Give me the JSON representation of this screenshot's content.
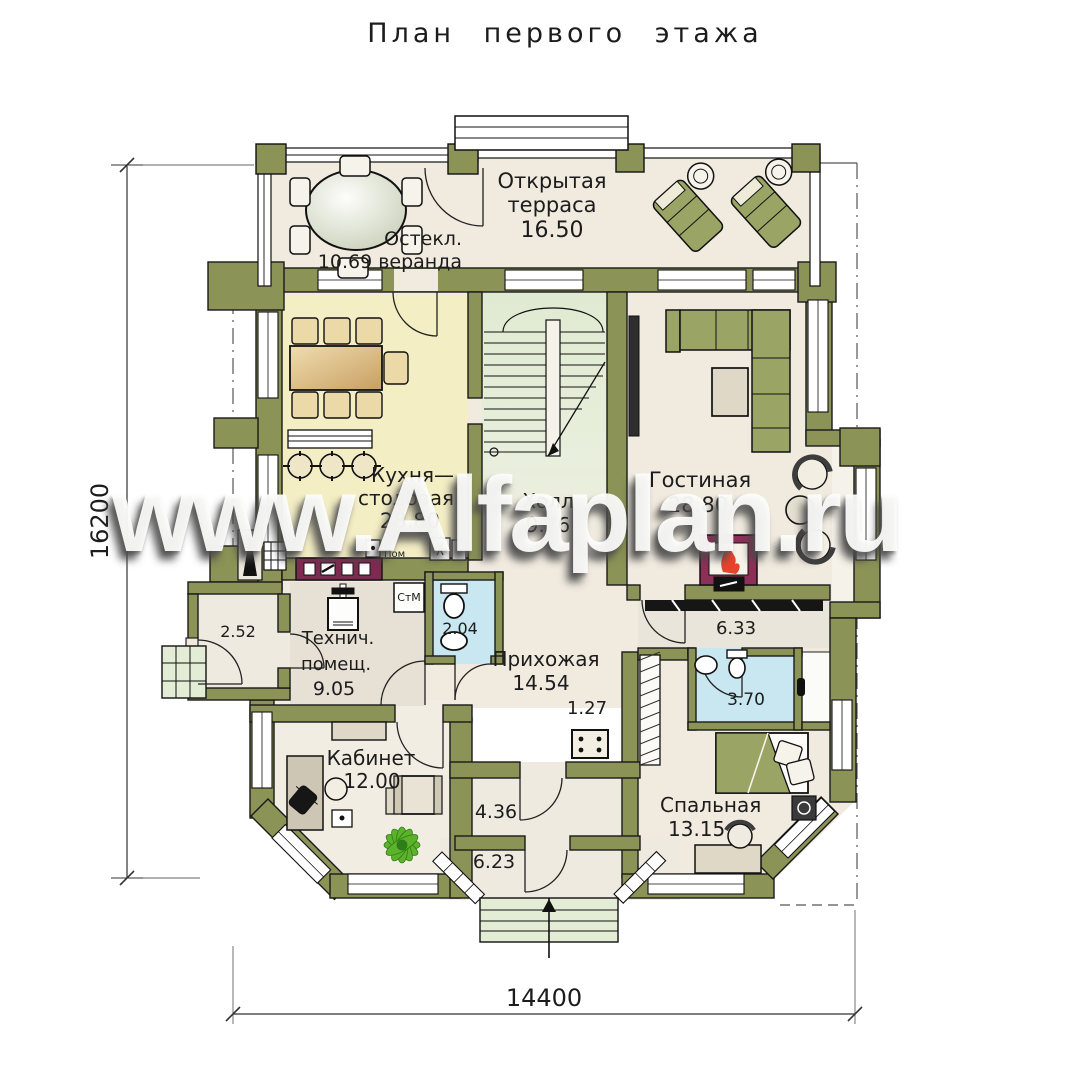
{
  "title": "План первого этажа",
  "watermark": "www.Alfaplan.ru",
  "dims": {
    "left": "16200",
    "bottom": "14400"
  },
  "rooms": {
    "terrace": {
      "l1": "Открытая",
      "l2": "терраса",
      "area": "16.50"
    },
    "veranda": {
      "l1": "Остекл.",
      "l2": "10.69 веранда"
    },
    "kitchen": {
      "l1": "Кухня—",
      "l2": "столовая",
      "area": "28.80"
    },
    "living": {
      "name": "Гостиная",
      "area": "28.80"
    },
    "hall": {
      "name": "Холл",
      "area": "9.76"
    },
    "tech": {
      "l1": "Технич.",
      "l2": "помещ.",
      "area": "9.05"
    },
    "entry": {
      "name": "Прихожая",
      "area": "14.54"
    },
    "closet": {
      "area": "1.27"
    },
    "office": {
      "name": "Кабинет",
      "area": "12.00"
    },
    "bedroom": {
      "name": "Спальная",
      "area": "13.15"
    },
    "bath1": {
      "area": "2.04"
    },
    "bath2": {
      "area": "3.70"
    },
    "vestibule": {
      "area": "2.52"
    },
    "corridor": {
      "area": "6.33"
    },
    "tambour": {
      "area": "4.36"
    },
    "porch": {
      "area": "6.23"
    }
  },
  "appliances": {
    "washer": "СтМ",
    "pantry": "Пом"
  },
  "colors": {
    "wall": "#8C9356",
    "floor": "#F0EADF",
    "kitchen_floor": "#F4EEC5",
    "bath_floor": "#C8E7F0",
    "stair_floor": "#E3ECD4",
    "cabinet_maroon": "#7D2B50",
    "furniture_olive": "#9AA565",
    "plant_green": "#5CB22A"
  }
}
